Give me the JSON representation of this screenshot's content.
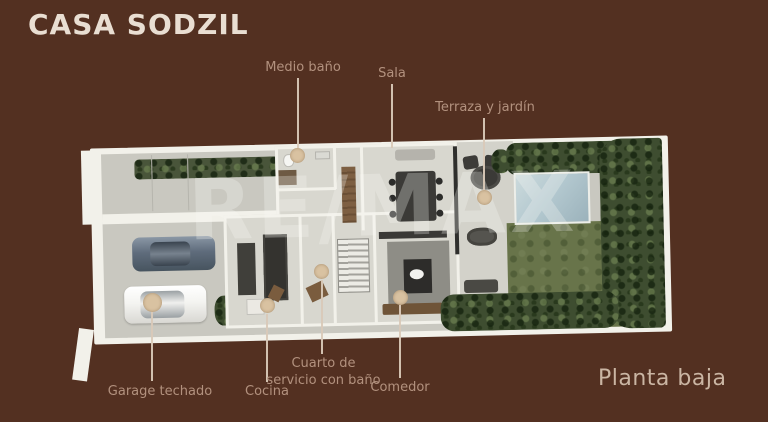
{
  "title": "CASA SODZIL",
  "watermark": "RE/MAX",
  "caption": "Planta baja",
  "labels": [
    {
      "name": "medio-bano",
      "text": "Medio baño"
    },
    {
      "name": "sala",
      "text": "Sala"
    },
    {
      "name": "terraza-jardin",
      "text": "Terraza y jardín"
    },
    {
      "name": "garage-techado",
      "text": "Garage techado"
    },
    {
      "name": "cocina",
      "text": "Cocina"
    },
    {
      "name": "cuarto-servicio",
      "text": "Cuarto de servicio con baño"
    },
    {
      "name": "comedor",
      "text": "Comedor"
    }
  ],
  "colors": {
    "background": "#533021",
    "title_text": "#e9ded2",
    "label_text": "#b2917e",
    "caption_text": "#cab5a3",
    "connector": "#d9c9b8",
    "marker": "#d9c2a1",
    "watermark": "#fafaf6",
    "wall": "#f2f1ea",
    "concrete": "#c9c8c0",
    "floor": "#d8d7cf",
    "grass": "#68744a",
    "bush": "#3e4d30",
    "hedge": "#49553a",
    "pool": "#b4c9d0",
    "car_blue": "#5f6c7c",
    "car_white": "#f4f4f1"
  }
}
